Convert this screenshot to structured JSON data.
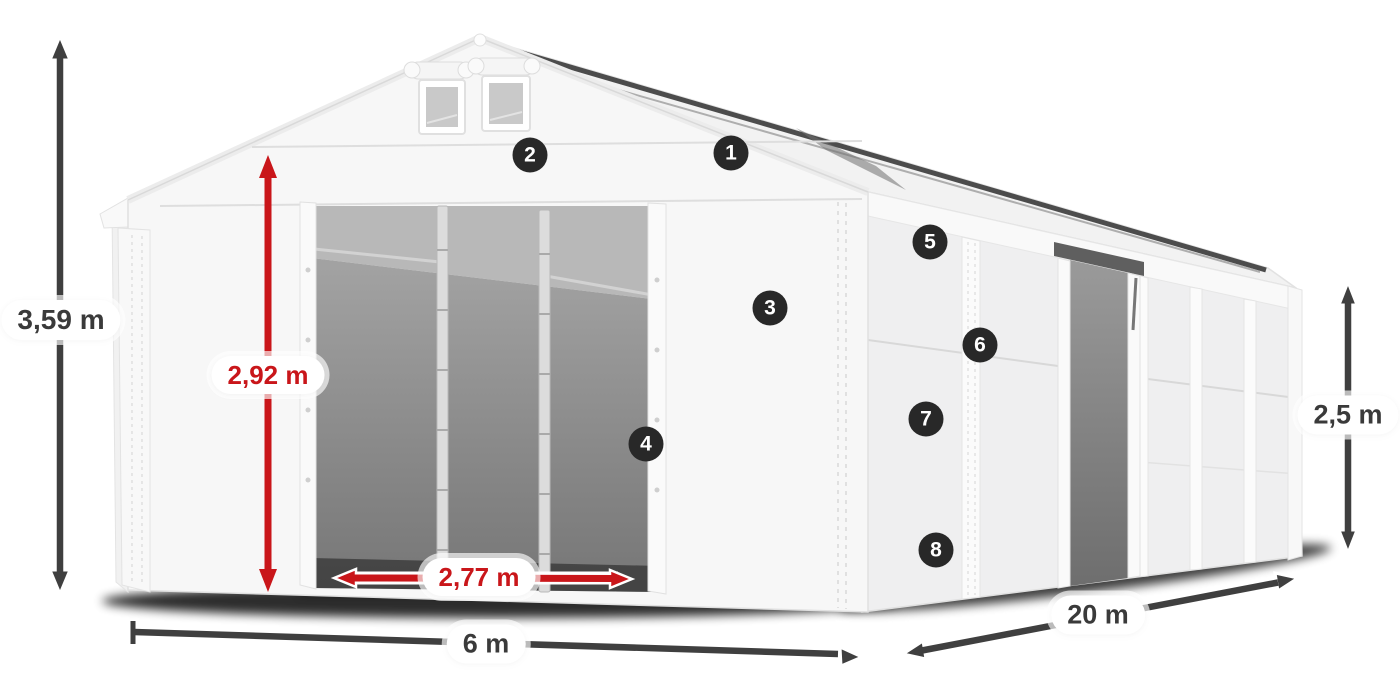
{
  "dimensions": {
    "total_height": "3,59 m",
    "door_height": "2,92 m",
    "door_width": "2,77 m",
    "front_width": "6 m",
    "side_length": "20 m",
    "side_height": "2,5 m"
  },
  "markers": [
    {
      "number": "1"
    },
    {
      "number": "2"
    },
    {
      "number": "3"
    },
    {
      "number": "4"
    },
    {
      "number": "5"
    },
    {
      "number": "6"
    },
    {
      "number": "7"
    },
    {
      "number": "8"
    }
  ],
  "colors": {
    "dimension_arrow_dark": "#3f3f3f",
    "dimension_arrow_red": "#c9161a",
    "marker_background": "#282828",
    "marker_text": "#ffffff",
    "tent_white": "#f7f7f7",
    "interior_gray": "#8a8a8a"
  }
}
